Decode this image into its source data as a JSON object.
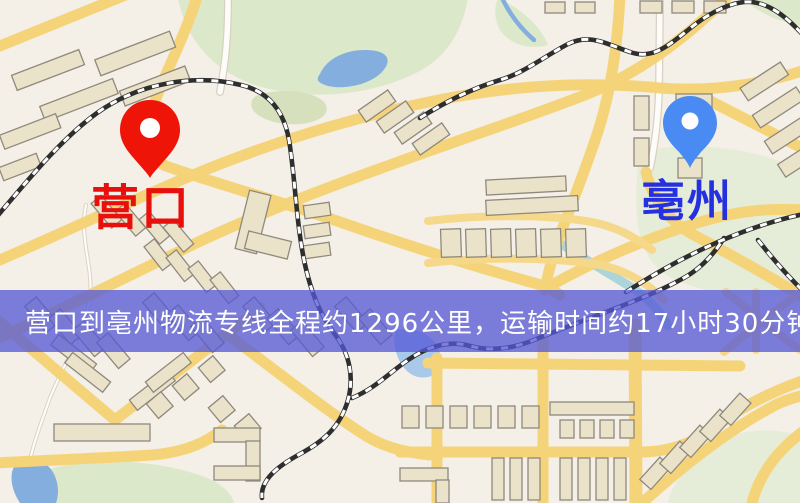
{
  "map": {
    "origin_label": "营口",
    "destination_label": "亳州",
    "banner_text": "营口到亳州物流专线全程约1296公里，运输时间约17小时30分钟.",
    "icons": {
      "origin_pin": "map-pin",
      "destination_pin": "map-pin"
    },
    "colors": {
      "base": "#f4efe7",
      "park": "#dce8ca",
      "park_light": "#e5edd8",
      "park_olive": "#d7e0bd",
      "water": "#84aedd",
      "water_light": "#a9c9ea",
      "stream": "#9fd0d6",
      "road": "#f5d479",
      "road_minor": "#f6d88a",
      "building": "#eae2c9",
      "building_stroke": "#8f897d",
      "railway": "#2e2e2e",
      "railway_dash": "#ffffff",
      "white_road": "#fdfcf8",
      "white_road_casing": "#d8d1c3",
      "origin_pin": "#ee1408",
      "origin_text": "#e8100c",
      "destination_pin": "#4a8af3",
      "destination_text": "#2531e0",
      "banner_bg": "#5459d7",
      "banner_text_color": "#ffffff"
    }
  }
}
